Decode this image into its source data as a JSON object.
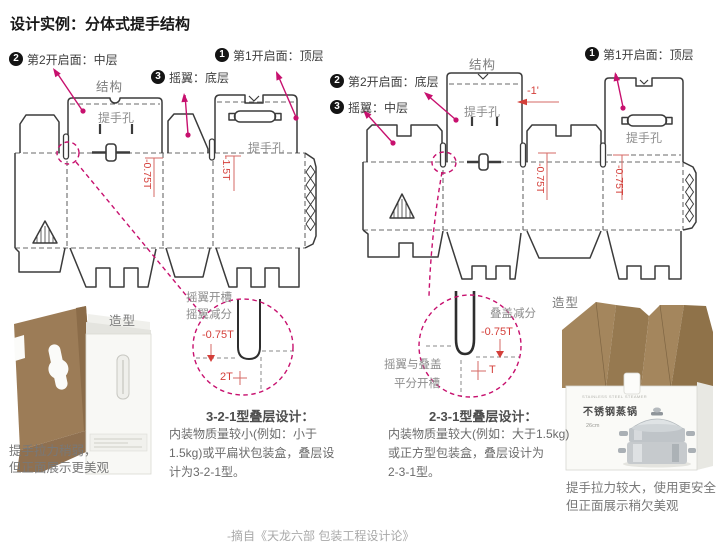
{
  "title": "设计实例：分体式提手结构",
  "footer": "-摘自《天龙六部 包装工程设计论》",
  "colors": {
    "magenta": "#c7106e",
    "red": "#d43f3a",
    "line": "#3b3b3b"
  },
  "left": {
    "structure_label": "结构",
    "annotations": [
      {
        "num": "2",
        "label": "第2开启面：中层"
      },
      {
        "num": "3",
        "label": "摇翼：底层"
      },
      {
        "num": "1",
        "label": "第1开启面：顶层"
      }
    ],
    "handle_hole_label_1": "提手孔",
    "handle_hole_label_2": "提手孔",
    "dim_1": "-0.75T",
    "dim_2": "-1.5T",
    "detail": {
      "label_1": "摇翼开槽",
      "label_2": "摇翼减分",
      "dim_1": "-0.75T",
      "dim_2": "2T"
    },
    "design": {
      "heading": "3-2-1型叠层设计：",
      "line_1": "内装物质量较小(例如：小于",
      "line_2": "1.5kg)或平扁状包装盒，叠层设",
      "line_3": "计为3-2-1型。"
    },
    "photo": {
      "label": "造型",
      "caption_1": "提手拉力稍弱，",
      "caption_2": "但正面展示更美观"
    }
  },
  "right": {
    "structure_label": "结构",
    "annotations": [
      {
        "num": "1",
        "label": "第1开启面：顶层"
      },
      {
        "num": "2",
        "label": "第2开启面：底层"
      },
      {
        "num": "3",
        "label": "摇翼：中层"
      }
    ],
    "handle_hole_label_1": "提手孔",
    "handle_hole_label_2": "提手孔",
    "dim_top": "-1'",
    "dim_1": "-0.75T",
    "dim_2": "-0.75T",
    "detail": {
      "label_1": "叠盖减分",
      "label_2": "摇翼与叠盖",
      "label_3": "平分开槽",
      "dim_1": "-0.75T",
      "dim_2": "T"
    },
    "design": {
      "heading": "2-3-1型叠层设计：",
      "line_1": "内装物质量较大(例如：大于1.5kg)",
      "line_2": "或正方型包装盒，叠层设计为",
      "line_3": "2-3-1型。"
    },
    "photo": {
      "label": "造型",
      "caption_1": "提手拉力较大，使用更安全",
      "caption_2": "但正面展示稍欠美观",
      "box_text_small": "STAINLESS STEEL STEAMER",
      "box_text_product": "不锈钢蒸锅",
      "box_text_size": "26cm"
    }
  }
}
